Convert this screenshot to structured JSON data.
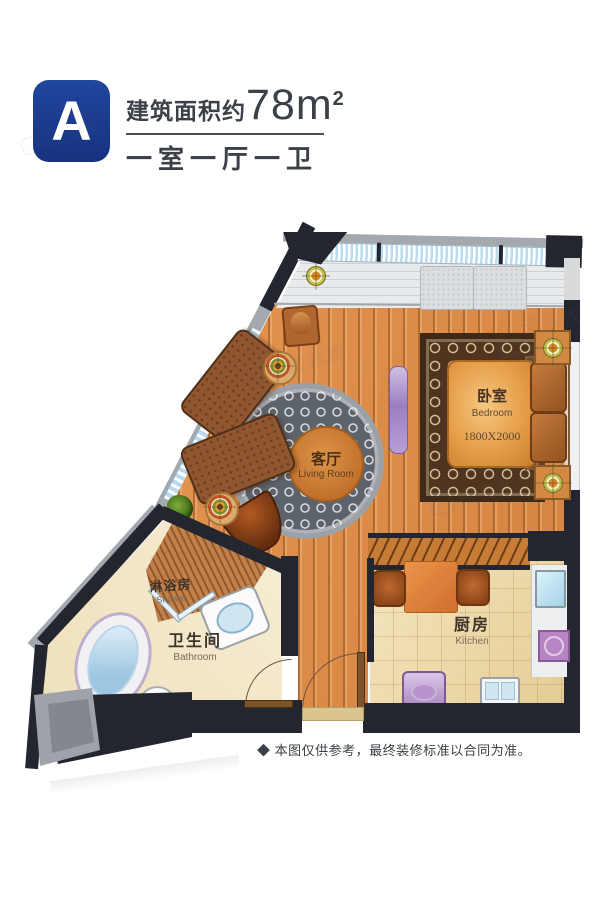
{
  "header": {
    "unit_label": "A",
    "area_prefix": "建筑面积约",
    "area_number": "78m",
    "area_sup": "2",
    "layout_config": "一室一厅一卫"
  },
  "rooms": {
    "bedroom": {
      "name_zh": "卧室",
      "name_en": "Bedroom",
      "bed_dim": "1800X2000"
    },
    "living": {
      "name_zh": "客厅",
      "name_en": "Living Room"
    },
    "kitchen": {
      "name_zh": "厨房",
      "name_en": "Kitchen"
    },
    "bathroom": {
      "name_zh": "卫生间",
      "name_en": "Bathroom"
    },
    "shower": {
      "name_zh": "淋浴房",
      "name_en": "Shower"
    }
  },
  "footer": {
    "disclaimer": "◆ 本图仅供参考，最终装修标准以合同为准。"
  },
  "watermark": {
    "brand": "诺言找房",
    "logo_glyph": "⌂"
  },
  "colors": {
    "badge_blue": "#1c3c92",
    "wall_dark": "#23262e",
    "floor_orange": "#dd8c4a",
    "text_dark": "#3c4148"
  }
}
